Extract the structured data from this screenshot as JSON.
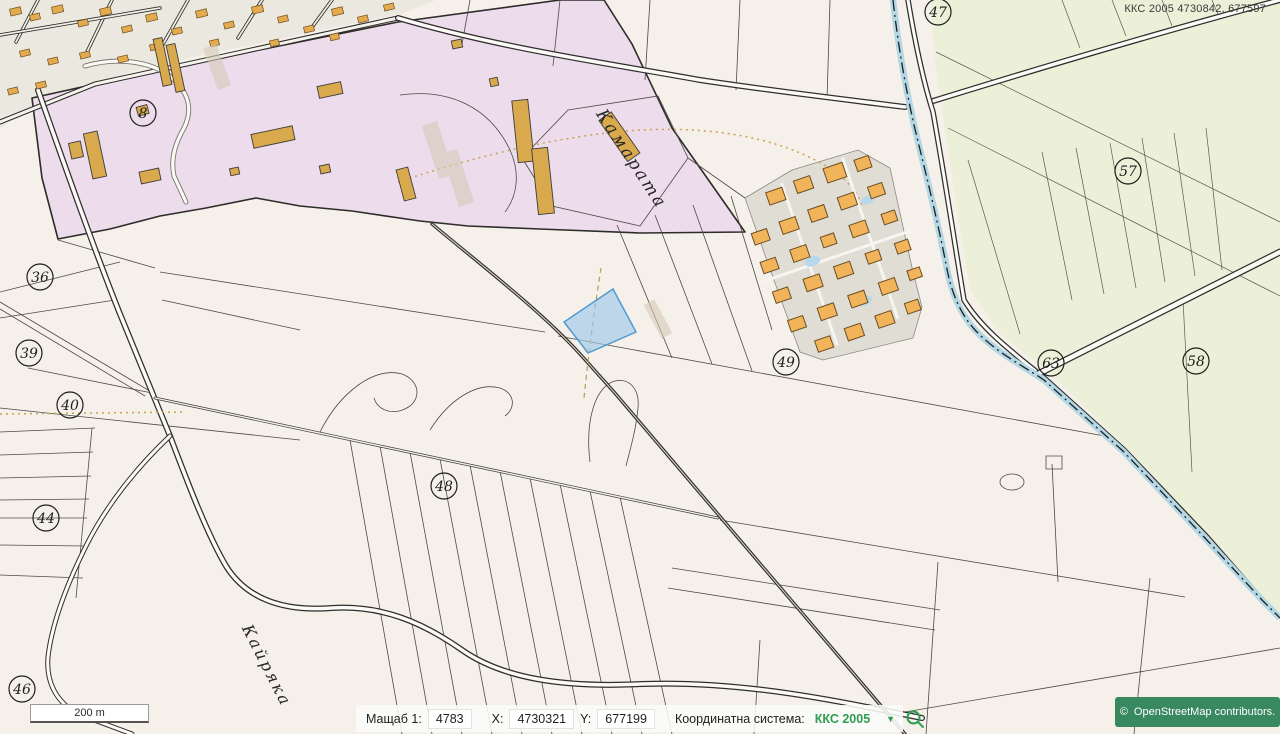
{
  "header": {
    "coords_readout": "ККС 2005 4730842, 677597"
  },
  "map": {
    "place_labels": [
      {
        "id": "kamarata",
        "text": "Камарата",
        "x": 627,
        "y": 162,
        "rotate": 57,
        "size": 17
      },
      {
        "id": "kayryaka",
        "text": "Кайряка",
        "x": 262,
        "y": 668,
        "rotate": 63,
        "size": 16
      }
    ],
    "parcel_numbers": [
      {
        "label": "8",
        "x": 143,
        "y": 113
      },
      {
        "label": "36",
        "x": 40,
        "y": 277
      },
      {
        "label": "39",
        "x": 29,
        "y": 353
      },
      {
        "label": "40",
        "x": 70,
        "y": 405
      },
      {
        "label": "44",
        "x": 46,
        "y": 518
      },
      {
        "label": "46",
        "x": 22,
        "y": 689
      },
      {
        "label": "48",
        "x": 444,
        "y": 486
      },
      {
        "label": "49",
        "x": 786,
        "y": 362
      },
      {
        "label": "47",
        "x": 938,
        "y": 12
      },
      {
        "label": "57",
        "x": 1128,
        "y": 171
      },
      {
        "label": "58",
        "x": 1196,
        "y": 361
      },
      {
        "label": "63",
        "x": 1051,
        "y": 363
      }
    ]
  },
  "statusbar": {
    "scale_label": "Мащаб 1:",
    "scale_value": "4783",
    "x_label": "X:",
    "x_value": "4730321",
    "y_label": "Y:",
    "y_value": "677199",
    "crs_label": "Координатна система:",
    "crs_value": "ККС 2005",
    "crs_dropdown_icon": "▼"
  },
  "scalebar": {
    "label": "200 m"
  },
  "attribution": {
    "copyright": "©",
    "text": "OpenStreetMap  contributors."
  },
  "colors": {
    "accent_green": "#2f9e52",
    "attribution_bg": "#388860",
    "selection_fill": "#9fc8e8",
    "selection_stroke": "#4f9ad0",
    "urban_purple": "#ecdcec",
    "farmland_green": "#edf0d8",
    "building_orange": "#f2b45a",
    "river_blue": "#b4d7e6"
  }
}
